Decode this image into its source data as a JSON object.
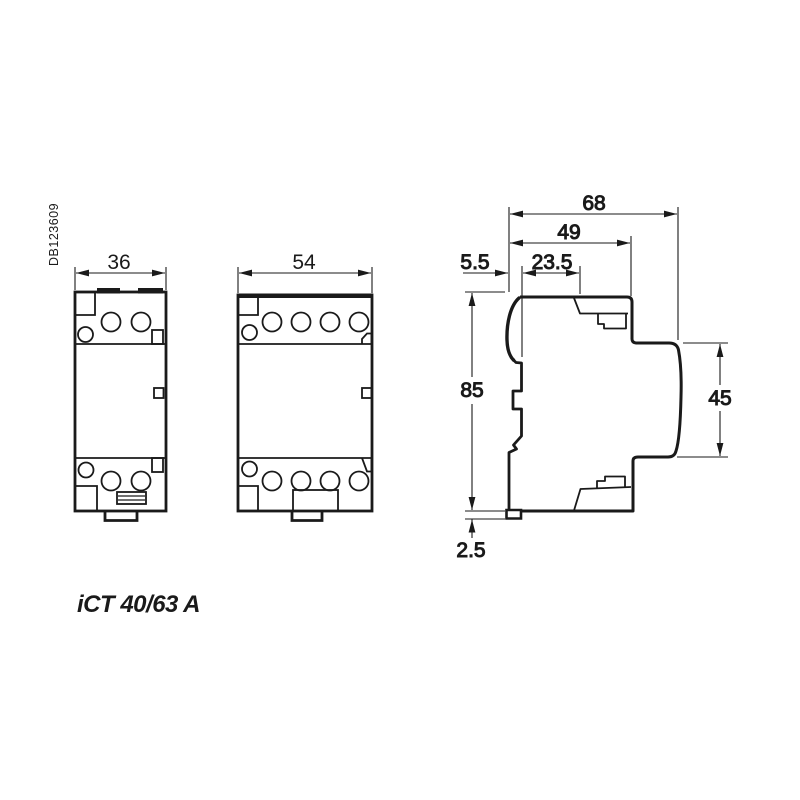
{
  "page": {
    "background": "#ffffff",
    "line_color": "#1a1a1a"
  },
  "annotations": {
    "doc_code": "DB123609",
    "product_label": "iCT 40/63 A"
  },
  "front_view_2pole": {
    "width_mm": "36"
  },
  "front_view_4pole": {
    "width_mm": "54"
  },
  "side_view": {
    "total_depth_mm": "68",
    "body_depth_mm": "49",
    "rail_offset_mm": "5.5",
    "front_section_depth_mm": "23.5",
    "height_mm": "85",
    "front_height_mm": "45",
    "foot_offset_mm": "2.5"
  }
}
